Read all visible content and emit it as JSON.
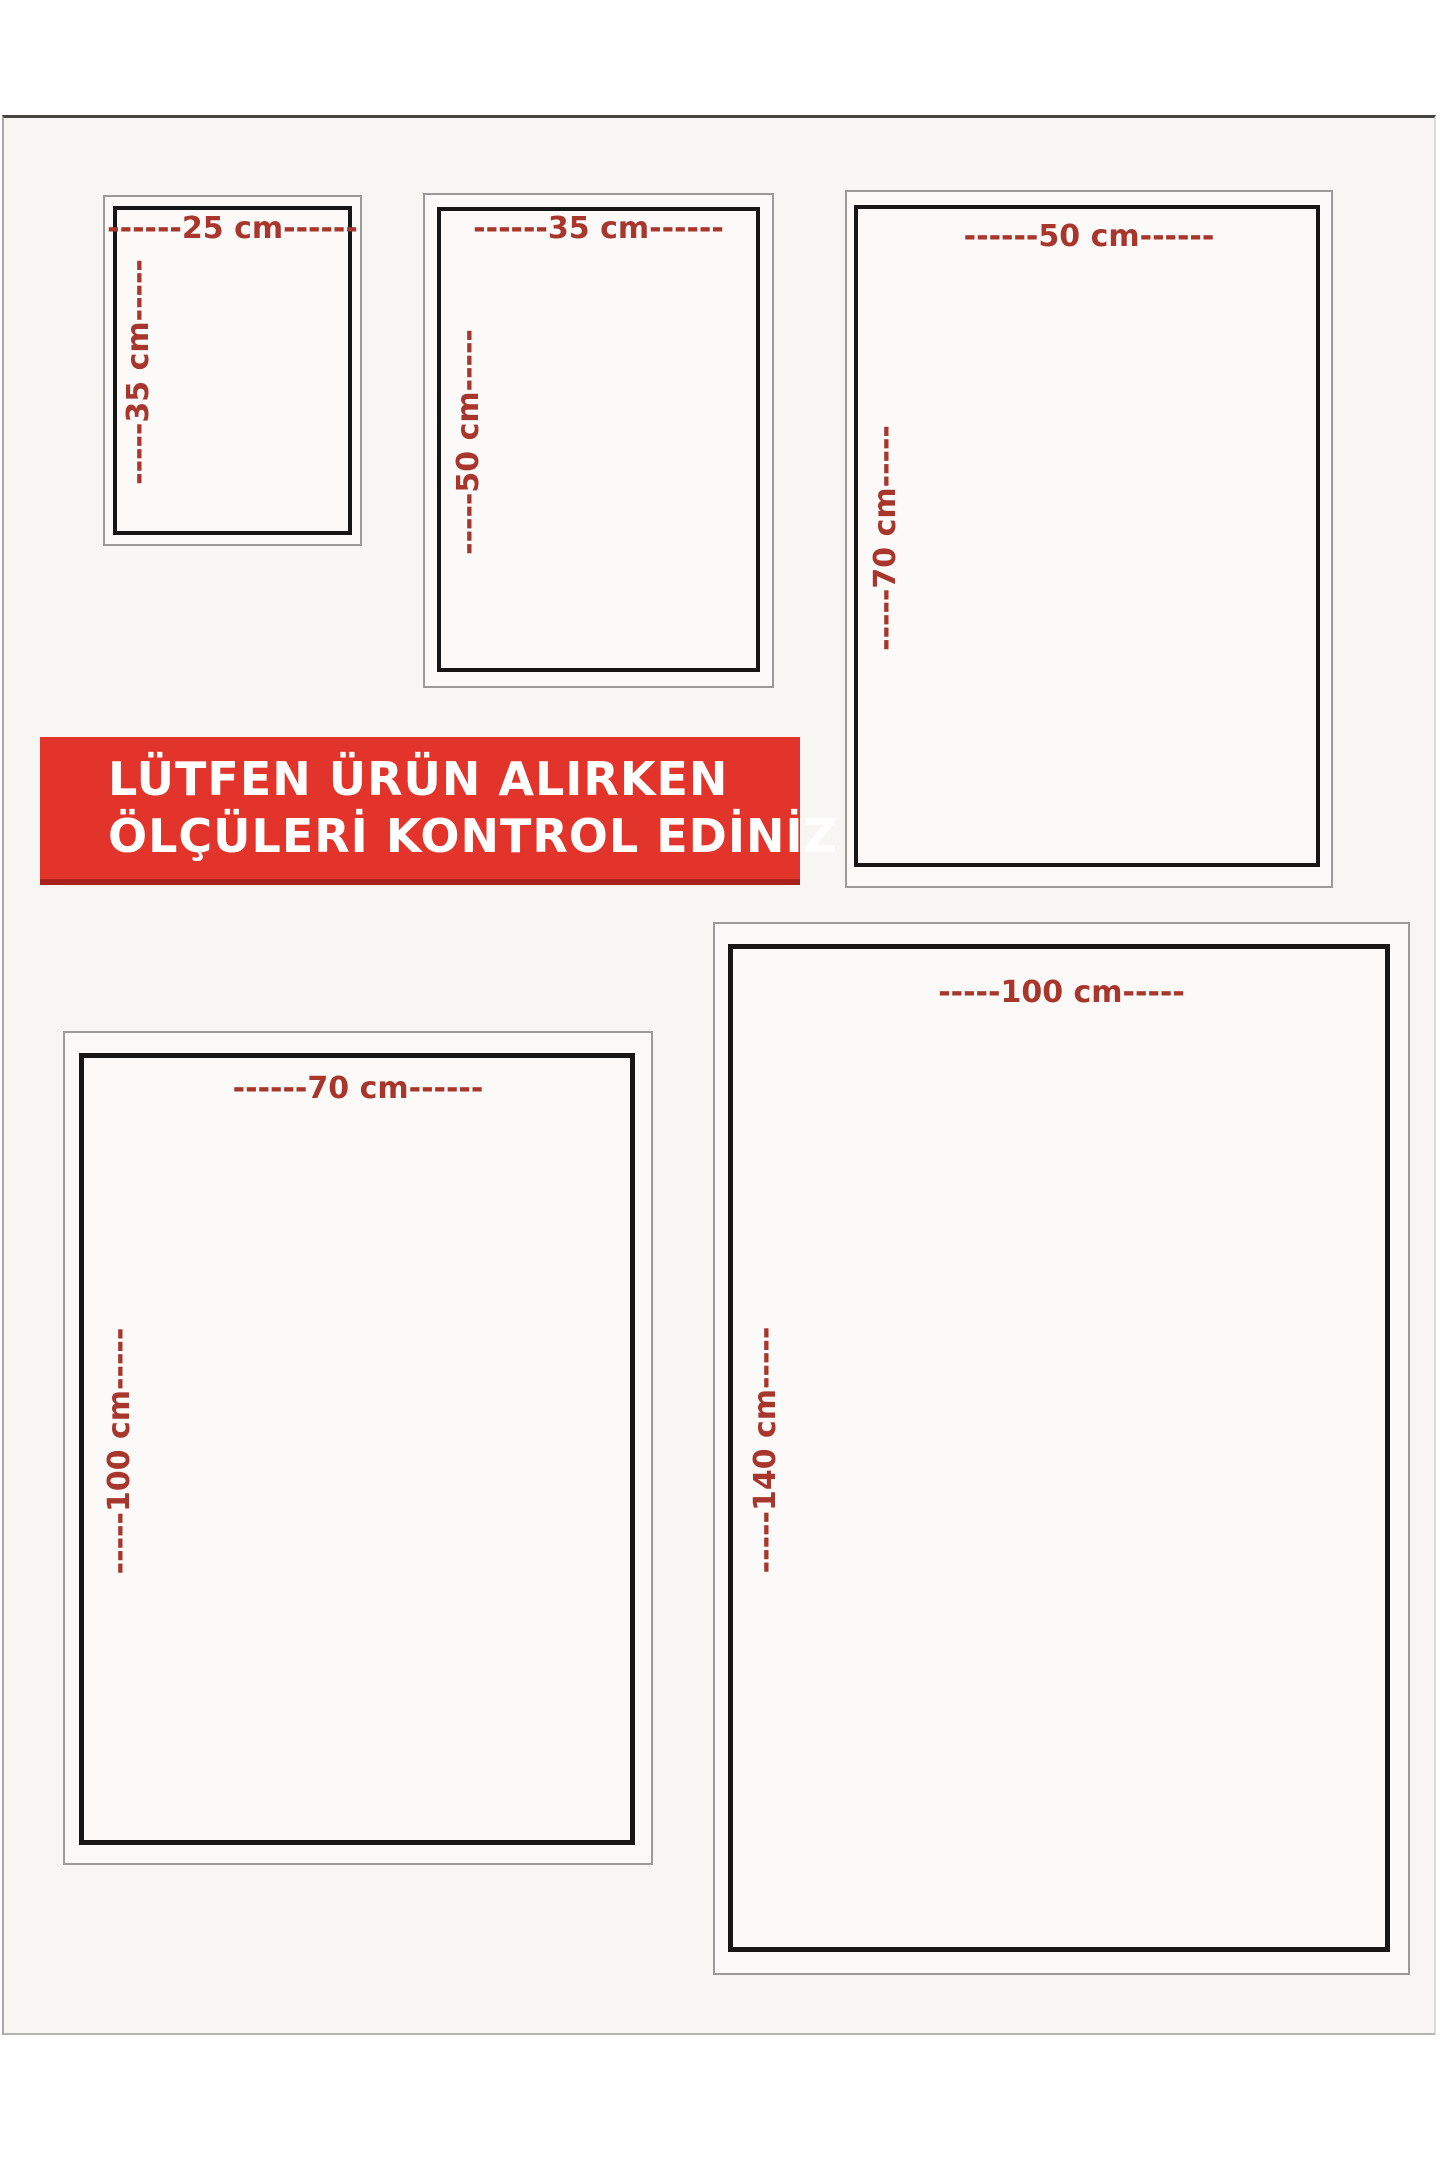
{
  "banner": {
    "line1": "LÜTFEN ÜRÜN ALIRKEN",
    "line2": "ÖLÇÜLERİ KONTROL EDİNİZ"
  },
  "colors": {
    "banner-red": "#e2342a",
    "banner-red-dark": "#a8211b",
    "label-red": "#a9362c",
    "frame-black": "#161616",
    "frame-gray": "#9c9a97",
    "page-bg": "#f7f6f3",
    "outer-bg": "#ffffff",
    "box-bg": "#fbfaf8"
  },
  "boxes": [
    {
      "size": "25x35",
      "width_cm": 25,
      "height_cm": 35,
      "width_label": "------25 cm------",
      "height_label": "-----35 cm-----"
    },
    {
      "size": "35x50",
      "width_cm": 35,
      "height_cm": 50,
      "width_label": "------35 cm------",
      "height_label": "-----50 cm-----"
    },
    {
      "size": "50x70",
      "width_cm": 50,
      "height_cm": 70,
      "width_label": "------50 cm------",
      "height_label": "-----70 cm-----"
    },
    {
      "size": "70x100",
      "width_cm": 70,
      "height_cm": 100,
      "width_label": "------70 cm------",
      "height_label": "-----100 cm-----"
    },
    {
      "size": "100x140",
      "width_cm": 100,
      "height_cm": 140,
      "width_label": "-----100 cm-----",
      "height_label": "-----140 cm-----"
    }
  ]
}
